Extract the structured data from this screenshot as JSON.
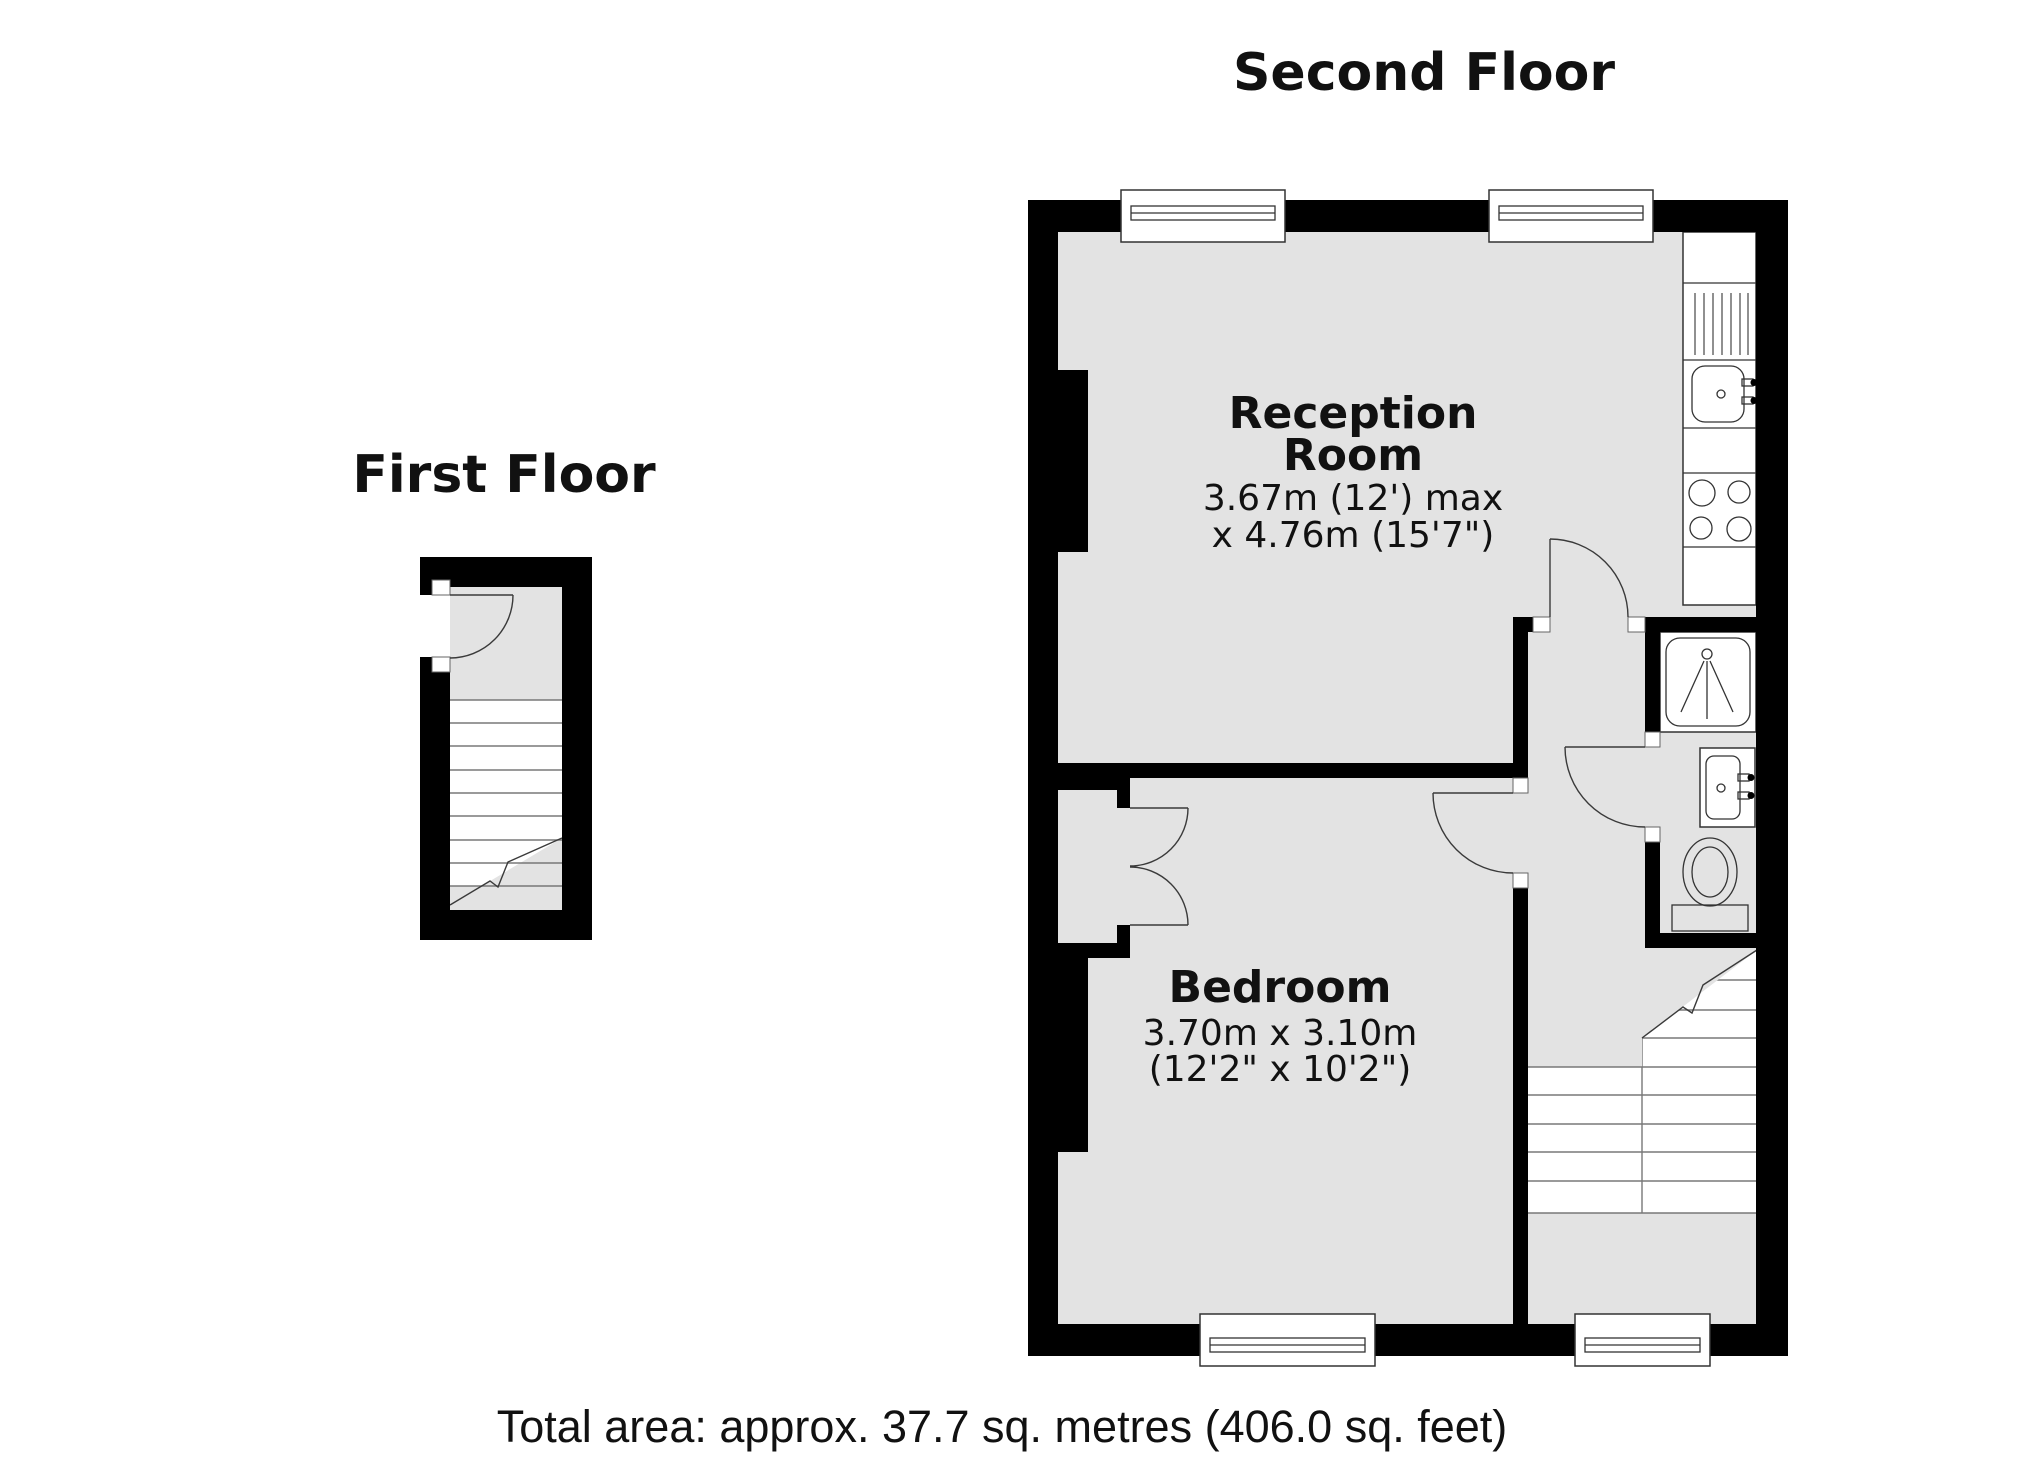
{
  "document": {
    "type": "estate-agent-floorplan",
    "background": "#ffffff"
  },
  "colors": {
    "wall": "#000000",
    "floor": "#e3e3e3",
    "fixture_outline": "#333333",
    "tread_line": "#787878",
    "door_arc": "#3a3a3a",
    "text": "#111111"
  },
  "second_floor": {
    "title": "Second Floor",
    "reception": {
      "name_line1": "Reception",
      "name_line2": "Room",
      "dims_line1": "3.67m (12') max",
      "dims_line2": "x 4.76m (15'7\")"
    },
    "bedroom": {
      "name": "Bedroom",
      "dims_line1": "3.70m x 3.10m",
      "dims_line2": "(12'2\" x 10'2\")"
    },
    "fixtures": {
      "kitchen_counter": "kitchen-counter",
      "drainer": "drainer-board",
      "sink": "kitchen-sink",
      "hob": "four-ring-hob",
      "shower": "shower-cubicle",
      "basin": "wash-basin",
      "toilet": "toilet",
      "stairs": "staircase-down",
      "windows": [
        "window-top-left",
        "window-top-right",
        "window-bedroom",
        "window-landing"
      ],
      "doors": [
        "reception-door",
        "bathroom-door",
        "bedroom-door",
        "wardrobe-double-doors"
      ]
    }
  },
  "first_floor": {
    "title": "First Floor",
    "fixtures": {
      "stairs": "staircase-up",
      "doors": [
        "entrance-door"
      ]
    }
  },
  "footer": {
    "total_area": "Total area: approx. 37.7 sq. metres (406.0 sq. feet)"
  }
}
